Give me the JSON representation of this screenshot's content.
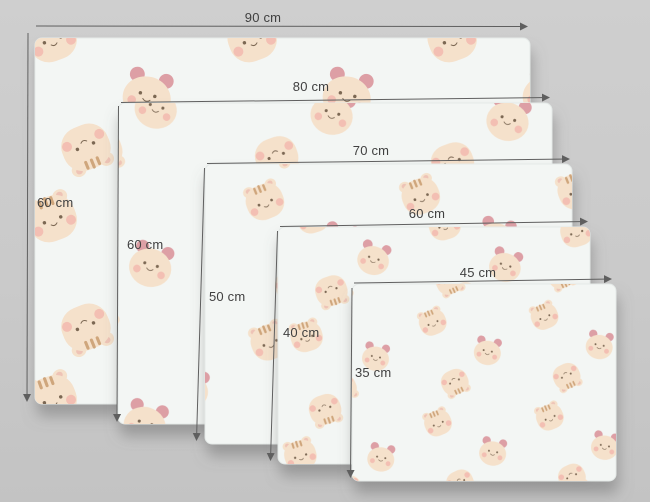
{
  "diagram": {
    "unit": "cm",
    "sheets": [
      {
        "id": "sheet-90x60",
        "width_cm": 90,
        "height_cm": 60,
        "width_label": "90 cm",
        "height_label": "60 cm"
      },
      {
        "id": "sheet-80x60",
        "width_cm": 80,
        "height_cm": 60,
        "width_label": "80 cm",
        "height_label": "60 cm"
      },
      {
        "id": "sheet-70x50",
        "width_cm": 70,
        "height_cm": 50,
        "width_label": "70 cm",
        "height_label": "50 cm"
      },
      {
        "id": "sheet-60x40",
        "width_cm": 60,
        "height_cm": 40,
        "width_label": "60 cm",
        "height_label": "40 cm"
      },
      {
        "id": "sheet-45x35",
        "width_cm": 45,
        "height_cm": 35,
        "width_label": "45 cm",
        "height_label": "35 cm"
      }
    ],
    "pattern_motifs": [
      "tiger-face",
      "bear-face"
    ]
  },
  "colors": {
    "bg": "#cacaca",
    "sheet": "#f3f6f4",
    "head": "#f5e1cb",
    "ear-inner": "#eec3b6",
    "ear-pink": "#dd9fa5",
    "cheek": "#f2b7ac",
    "stripe": "#c89b6e",
    "feature": "#7b6753",
    "line": "#5f5f5f",
    "text": "#404040"
  }
}
